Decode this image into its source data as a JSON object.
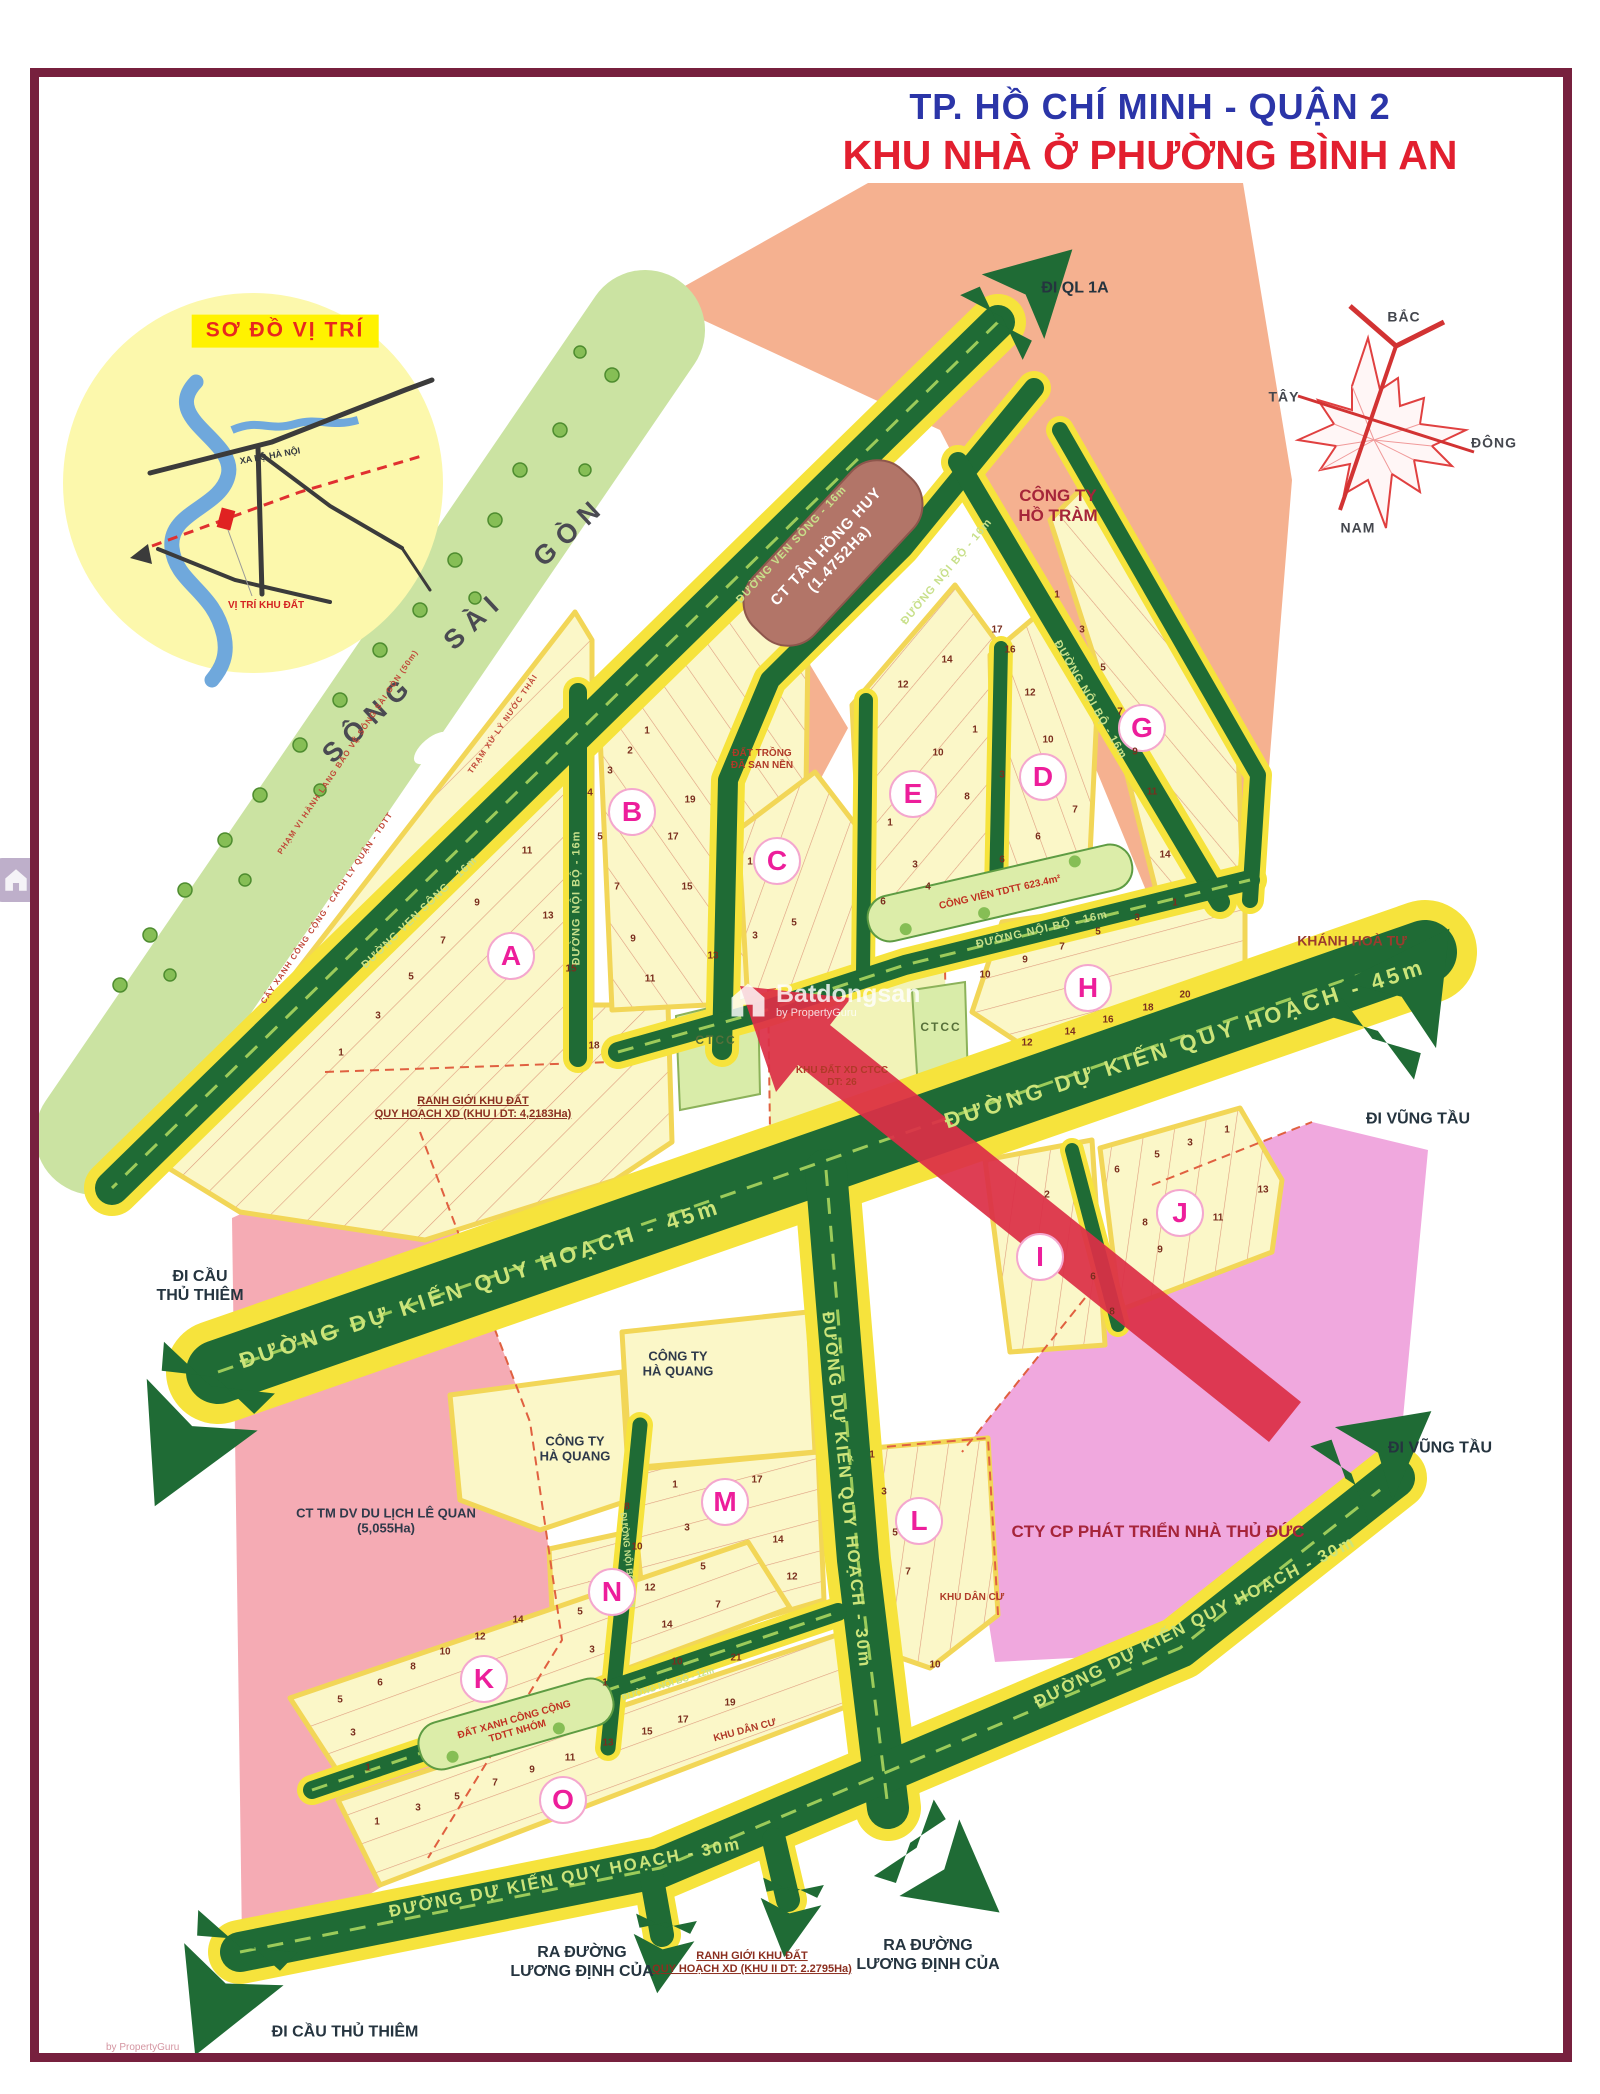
{
  "title": {
    "line1": "TP. HỒ CHÍ MINH - QUẬN 2",
    "line2": "KHU NHÀ Ở PHƯỜNG BÌNH AN"
  },
  "watermark": {
    "brand": "Batdongsan",
    "sub": "by PropertyGuru"
  },
  "colors": {
    "frame": "#77203E",
    "road_green": "#1F6B35",
    "road_yellow": "#F6E33C",
    "lots_yellow": "#FBF7C8",
    "salmon": "#F5B190",
    "park_green": "#CBE3A2",
    "strip_green": "#DCEDA9",
    "pink_left": "#F5ABB4",
    "pink_right": "#F0A8DE",
    "brown_block": "#B27568",
    "red_arrow": "#DC2F47",
    "letter_pink": "#ED1E9B",
    "title_blue": "#2B35A8",
    "title_red": "#E21F2F"
  },
  "map": {
    "labels": [
      {
        "t": "ĐI QL 1A",
        "x": 1075,
        "y": 289,
        "r": 0,
        "c": "dir"
      },
      {
        "t": "SÔNG SÀI GÒN",
        "x": 465,
        "y": 630,
        "r": -43,
        "c": "river"
      },
      {
        "t": "PHẠM VI HÀNH LANG BẢO VỆ SÔNG SÀI GÒN (50m)",
        "x": 348,
        "y": 752,
        "r": -56,
        "c": "tiny-note"
      },
      {
        "t": "TRẠM XỬ LÝ NƯỚC THẢI",
        "x": 503,
        "y": 724,
        "r": -56,
        "c": "tiny-note"
      },
      {
        "t": "CÂY XANH CÔNG CỘNG - CÁCH LY QUẬN - TDTT",
        "x": 327,
        "y": 908,
        "r": -56,
        "c": "tiny-note"
      },
      {
        "t": "CT TÂN HỒNG HUY\n(1.4752Ha)",
        "x": 833,
        "y": 553,
        "r": -47,
        "c": "brown"
      },
      {
        "t": "CÔNG TY\nHỒ TRÀM",
        "x": 1058,
        "y": 506,
        "r": 0,
        "c": "region-lg"
      },
      {
        "t": "ĐẤT TRỒNG\nĐÃ SAN NỀN",
        "x": 762,
        "y": 760,
        "r": 0,
        "c": "note"
      },
      {
        "t": "ĐƯỜNG VEN SÔNG - 16m",
        "x": 792,
        "y": 545,
        "r": -47,
        "c": "road-sm"
      },
      {
        "t": "ĐƯỜNG VEN SÔNG - 16m",
        "x": 420,
        "y": 913,
        "r": -44,
        "c": "road-sm"
      },
      {
        "t": "ĐƯỜNG NỘI BỘ - 16m",
        "x": 947,
        "y": 572,
        "r": -50,
        "c": "road-sm"
      },
      {
        "t": "ĐƯỜNG NỘI BỘ - 16m",
        "x": 1090,
        "y": 700,
        "r": 60,
        "c": "road-sm"
      },
      {
        "t": "ĐƯỜNG NỘI BỘ - 16m",
        "x": 577,
        "y": 898,
        "r": -90,
        "c": "road-sm"
      },
      {
        "t": "ĐƯỜNG NỘI BỘ - 16m",
        "x": 1042,
        "y": 930,
        "r": -13,
        "c": "road-sm"
      },
      {
        "t": "CÔNG VIÊN TDTT 623.4m²",
        "x": 1000,
        "y": 893,
        "r": -13,
        "c": "park-note"
      },
      {
        "t": "KHÁNH HOÀ TỰ",
        "x": 1352,
        "y": 941,
        "r": 0,
        "c": "region"
      },
      {
        "t": "CTCC",
        "x": 716,
        "y": 1040,
        "r": 0,
        "c": "ctcc"
      },
      {
        "t": "CTCC",
        "x": 941,
        "y": 1027,
        "r": 0,
        "c": "ctcc"
      },
      {
        "t": "KHU ĐẤT XD CTCC\nDT: 26",
        "x": 842,
        "y": 1077,
        "r": 0,
        "c": "note"
      },
      {
        "t": "RANH GIỚI KHU ĐẤT\nQUY HOẠCH XD (KHU I DT: 4,2183Ha)",
        "x": 473,
        "y": 1108,
        "r": 0,
        "c": "ranh"
      },
      {
        "t": "ĐƯỜNG DỰ KIẾN QUY HOẠCH - 45m",
        "x": 480,
        "y": 1284,
        "r": -18,
        "c": "road-lg"
      },
      {
        "t": "ĐƯỜNG DỰ KIẾN QUY HOẠCH - 45m",
        "x": 1185,
        "y": 1044,
        "r": -18,
        "c": "road-lg"
      },
      {
        "t": "ĐI CẦU\nTHỦ THIÊM",
        "x": 200,
        "y": 1287,
        "r": 0,
        "c": "dir"
      },
      {
        "t": "ĐI VŨNG TẦU",
        "x": 1418,
        "y": 1120,
        "r": 0,
        "c": "dir"
      },
      {
        "t": "ĐI VŨNG TẦU",
        "x": 1440,
        "y": 1449,
        "r": 0,
        "c": "dir"
      },
      {
        "t": "ĐƯỜNG DỰ KIẾN QUY HOẠCH - 30m",
        "x": 846,
        "y": 1490,
        "r": 84,
        "c": "road-md"
      },
      {
        "t": "ĐƯỜNG DỰ KIẾN QUY HOẠCH - 30m",
        "x": 565,
        "y": 1878,
        "r": -11,
        "c": "road-md"
      },
      {
        "t": "ĐƯỜNG DỰ KIẾN QUY HOẠCH - 30m",
        "x": 1195,
        "y": 1622,
        "r": -27,
        "c": "road-md"
      },
      {
        "t": "CÔNG TY\nHÀ QUANG",
        "x": 678,
        "y": 1364,
        "r": 0,
        "c": "dark"
      },
      {
        "t": "CÔNG TY\nHÀ QUANG",
        "x": 575,
        "y": 1449,
        "r": 0,
        "c": "dark"
      },
      {
        "t": "CT TM DV DU LỊCH LÊ QUAN\n(5,055Ha)",
        "x": 386,
        "y": 1521,
        "r": 0,
        "c": "dark"
      },
      {
        "t": "CTY CP PHÁT TRIỂN NHÀ THỦ ĐỨC",
        "x": 1158,
        "y": 1532,
        "r": 0,
        "c": "region-lg"
      },
      {
        "t": "KHU DÂN CƯ",
        "x": 972,
        "y": 1598,
        "r": 0,
        "c": "note"
      },
      {
        "t": "KHU DÂN CƯ",
        "x": 745,
        "y": 1731,
        "r": -15,
        "c": "note"
      },
      {
        "t": "ĐẤT XANH CÔNG CỘNG\nTDTT NHÓM",
        "x": 516,
        "y": 1726,
        "r": -16,
        "c": "park-note"
      },
      {
        "t": "ĐƯỜNG NỘI BỘ - 12m",
        "x": 668,
        "y": 1684,
        "r": -17,
        "c": "road-xs"
      },
      {
        "t": "ĐƯỜNG NỘI BỘ - 12m",
        "x": 628,
        "y": 1560,
        "r": 84,
        "c": "road-xs"
      },
      {
        "t": "RA ĐƯỜNG\nLƯƠNG ĐỊNH CỦA",
        "x": 582,
        "y": 1963,
        "r": 0,
        "c": "dir"
      },
      {
        "t": "RA ĐƯỜNG\nLƯƠNG ĐỊNH CỦA",
        "x": 928,
        "y": 1956,
        "r": 0,
        "c": "dir"
      },
      {
        "t": "RANH GIỚI KHU ĐẤT\nQUY HOẠCH XD (KHU II DT: 2.2795Ha)",
        "x": 752,
        "y": 1963,
        "r": 0,
        "c": "ranh"
      },
      {
        "t": "ĐI CẦU THỦ THIÊM",
        "x": 345,
        "y": 2033,
        "r": 0,
        "c": "dir"
      },
      {
        "t": "SƠ ĐỒ VỊ TRÍ",
        "x": 285,
        "y": 331,
        "r": 0,
        "c": "inset-title"
      },
      {
        "t": "XA LỘ HÀ NỘI",
        "x": 270,
        "y": 456,
        "r": -10,
        "c": "tiny-dark"
      },
      {
        "t": "VỊ TRÍ KHU ĐẤT",
        "x": 266,
        "y": 606,
        "r": 0,
        "c": "tiny-red"
      },
      {
        "t": "BẮC",
        "x": 1404,
        "y": 317,
        "r": 0,
        "c": "compass"
      },
      {
        "t": "TÂY",
        "x": 1284,
        "y": 397,
        "r": 0,
        "c": "compass"
      },
      {
        "t": "ĐÔNG",
        "x": 1494,
        "y": 443,
        "r": 0,
        "c": "compass"
      },
      {
        "t": "NAM",
        "x": 1358,
        "y": 528,
        "r": 0,
        "c": "compass"
      }
    ],
    "blocks": [
      {
        "letter": "A",
        "x": 511,
        "y": 956
      },
      {
        "letter": "B",
        "x": 632,
        "y": 812
      },
      {
        "letter": "C",
        "x": 777,
        "y": 861
      },
      {
        "letter": "D",
        "x": 1043,
        "y": 777
      },
      {
        "letter": "E",
        "x": 913,
        "y": 794
      },
      {
        "letter": "G",
        "x": 1142,
        "y": 728
      },
      {
        "letter": "H",
        "x": 1088,
        "y": 988
      },
      {
        "letter": "I",
        "x": 1040,
        "y": 1257
      },
      {
        "letter": "J",
        "x": 1180,
        "y": 1213
      },
      {
        "letter": "K",
        "x": 484,
        "y": 1679
      },
      {
        "letter": "L",
        "x": 919,
        "y": 1521
      },
      {
        "letter": "M",
        "x": 725,
        "y": 1502
      },
      {
        "letter": "N",
        "x": 612,
        "y": 1592
      },
      {
        "letter": "O",
        "x": 563,
        "y": 1800
      }
    ],
    "lots": [
      {
        "n": "11",
        "x": 527,
        "y": 851
      },
      {
        "n": "9",
        "x": 477,
        "y": 903
      },
      {
        "n": "13",
        "x": 548,
        "y": 916
      },
      {
        "n": "7",
        "x": 443,
        "y": 941
      },
      {
        "n": "15",
        "x": 571,
        "y": 969
      },
      {
        "n": "5",
        "x": 411,
        "y": 977
      },
      {
        "n": "3",
        "x": 378,
        "y": 1016
      },
      {
        "n": "1",
        "x": 341,
        "y": 1053
      },
      {
        "n": "18",
        "x": 594,
        "y": 1046
      },
      {
        "n": "1",
        "x": 647,
        "y": 731
      },
      {
        "n": "2",
        "x": 630,
        "y": 751
      },
      {
        "n": "3",
        "x": 610,
        "y": 771
      },
      {
        "n": "4",
        "x": 590,
        "y": 793
      },
      {
        "n": "19",
        "x": 690,
        "y": 800
      },
      {
        "n": "5",
        "x": 600,
        "y": 837
      },
      {
        "n": "17",
        "x": 673,
        "y": 837
      },
      {
        "n": "7",
        "x": 617,
        "y": 887
      },
      {
        "n": "15",
        "x": 687,
        "y": 887
      },
      {
        "n": "9",
        "x": 633,
        "y": 939
      },
      {
        "n": "13",
        "x": 713,
        "y": 956
      },
      {
        "n": "11",
        "x": 650,
        "y": 979
      },
      {
        "n": "1",
        "x": 750,
        "y": 862
      },
      {
        "n": "3",
        "x": 755,
        "y": 936
      },
      {
        "n": "5",
        "x": 794,
        "y": 923
      },
      {
        "n": "17",
        "x": 997,
        "y": 630
      },
      {
        "n": "16",
        "x": 1010,
        "y": 650
      },
      {
        "n": "14",
        "x": 947,
        "y": 660
      },
      {
        "n": "12",
        "x": 903,
        "y": 685
      },
      {
        "n": "1",
        "x": 975,
        "y": 730
      },
      {
        "n": "10",
        "x": 938,
        "y": 753
      },
      {
        "n": "3",
        "x": 1002,
        "y": 775
      },
      {
        "n": "8",
        "x": 967,
        "y": 797
      },
      {
        "n": "1",
        "x": 890,
        "y": 823
      },
      {
        "n": "6",
        "x": 1002,
        "y": 860
      },
      {
        "n": "3",
        "x": 915,
        "y": 865
      },
      {
        "n": "4",
        "x": 928,
        "y": 887
      },
      {
        "n": "6",
        "x": 883,
        "y": 902
      },
      {
        "n": "12",
        "x": 1030,
        "y": 693
      },
      {
        "n": "10",
        "x": 1048,
        "y": 740
      },
      {
        "n": "7",
        "x": 1075,
        "y": 810
      },
      {
        "n": "6",
        "x": 1038,
        "y": 837
      },
      {
        "n": "1",
        "x": 1057,
        "y": 595
      },
      {
        "n": "3",
        "x": 1082,
        "y": 630
      },
      {
        "n": "5",
        "x": 1103,
        "y": 668
      },
      {
        "n": "7",
        "x": 1120,
        "y": 712
      },
      {
        "n": "9",
        "x": 1135,
        "y": 752
      },
      {
        "n": "11",
        "x": 1152,
        "y": 792
      },
      {
        "n": "14",
        "x": 1165,
        "y": 855
      },
      {
        "n": "1",
        "x": 1175,
        "y": 903
      },
      {
        "n": "3",
        "x": 1137,
        "y": 918
      },
      {
        "n": "5",
        "x": 1098,
        "y": 932
      },
      {
        "n": "7",
        "x": 1062,
        "y": 947
      },
      {
        "n": "9",
        "x": 1025,
        "y": 960
      },
      {
        "n": "10",
        "x": 985,
        "y": 975
      },
      {
        "n": "20",
        "x": 1185,
        "y": 995
      },
      {
        "n": "18",
        "x": 1148,
        "y": 1008
      },
      {
        "n": "16",
        "x": 1108,
        "y": 1020
      },
      {
        "n": "14",
        "x": 1070,
        "y": 1032
      },
      {
        "n": "12",
        "x": 1027,
        "y": 1043
      },
      {
        "n": "6",
        "x": 1117,
        "y": 1170
      },
      {
        "n": "5",
        "x": 1157,
        "y": 1155
      },
      {
        "n": "3",
        "x": 1190,
        "y": 1143
      },
      {
        "n": "1",
        "x": 1227,
        "y": 1130
      },
      {
        "n": "13",
        "x": 1263,
        "y": 1190
      },
      {
        "n": "11",
        "x": 1218,
        "y": 1218
      },
      {
        "n": "8",
        "x": 1145,
        "y": 1223
      },
      {
        "n": "9",
        "x": 1160,
        "y": 1250
      },
      {
        "n": "2",
        "x": 1047,
        "y": 1195
      },
      {
        "n": "6",
        "x": 1093,
        "y": 1277
      },
      {
        "n": "8",
        "x": 1112,
        "y": 1312
      },
      {
        "n": "1",
        "x": 675,
        "y": 1485
      },
      {
        "n": "17",
        "x": 757,
        "y": 1480
      },
      {
        "n": "8",
        "x": 627,
        "y": 1507
      },
      {
        "n": "3",
        "x": 687,
        "y": 1528
      },
      {
        "n": "14",
        "x": 778,
        "y": 1540
      },
      {
        "n": "10",
        "x": 637,
        "y": 1547
      },
      {
        "n": "5",
        "x": 703,
        "y": 1567
      },
      {
        "n": "12",
        "x": 792,
        "y": 1577
      },
      {
        "n": "7",
        "x": 718,
        "y": 1605
      },
      {
        "n": "21",
        "x": 736,
        "y": 1658
      },
      {
        "n": "19",
        "x": 730,
        "y": 1703
      },
      {
        "n": "5",
        "x": 580,
        "y": 1612
      },
      {
        "n": "12",
        "x": 650,
        "y": 1588
      },
      {
        "n": "3",
        "x": 592,
        "y": 1650
      },
      {
        "n": "14",
        "x": 667,
        "y": 1625
      },
      {
        "n": "1",
        "x": 605,
        "y": 1683
      },
      {
        "n": "10",
        "x": 677,
        "y": 1662
      },
      {
        "n": "14",
        "x": 518,
        "y": 1620
      },
      {
        "n": "12",
        "x": 480,
        "y": 1637
      },
      {
        "n": "10",
        "x": 445,
        "y": 1652
      },
      {
        "n": "8",
        "x": 413,
        "y": 1667
      },
      {
        "n": "6",
        "x": 380,
        "y": 1683
      },
      {
        "n": "5",
        "x": 340,
        "y": 1700
      },
      {
        "n": "3",
        "x": 353,
        "y": 1733
      },
      {
        "n": "1",
        "x": 368,
        "y": 1768
      },
      {
        "n": "17",
        "x": 683,
        "y": 1720
      },
      {
        "n": "15",
        "x": 647,
        "y": 1732
      },
      {
        "n": "13",
        "x": 608,
        "y": 1743
      },
      {
        "n": "11",
        "x": 570,
        "y": 1758
      },
      {
        "n": "9",
        "x": 532,
        "y": 1770
      },
      {
        "n": "7",
        "x": 495,
        "y": 1783
      },
      {
        "n": "5",
        "x": 457,
        "y": 1797
      },
      {
        "n": "3",
        "x": 418,
        "y": 1808
      },
      {
        "n": "1",
        "x": 377,
        "y": 1822
      },
      {
        "n": "1",
        "x": 872,
        "y": 1455
      },
      {
        "n": "3",
        "x": 884,
        "y": 1492
      },
      {
        "n": "5",
        "x": 895,
        "y": 1533
      },
      {
        "n": "7",
        "x": 908,
        "y": 1572
      },
      {
        "n": "10",
        "x": 935,
        "y": 1665
      }
    ]
  }
}
